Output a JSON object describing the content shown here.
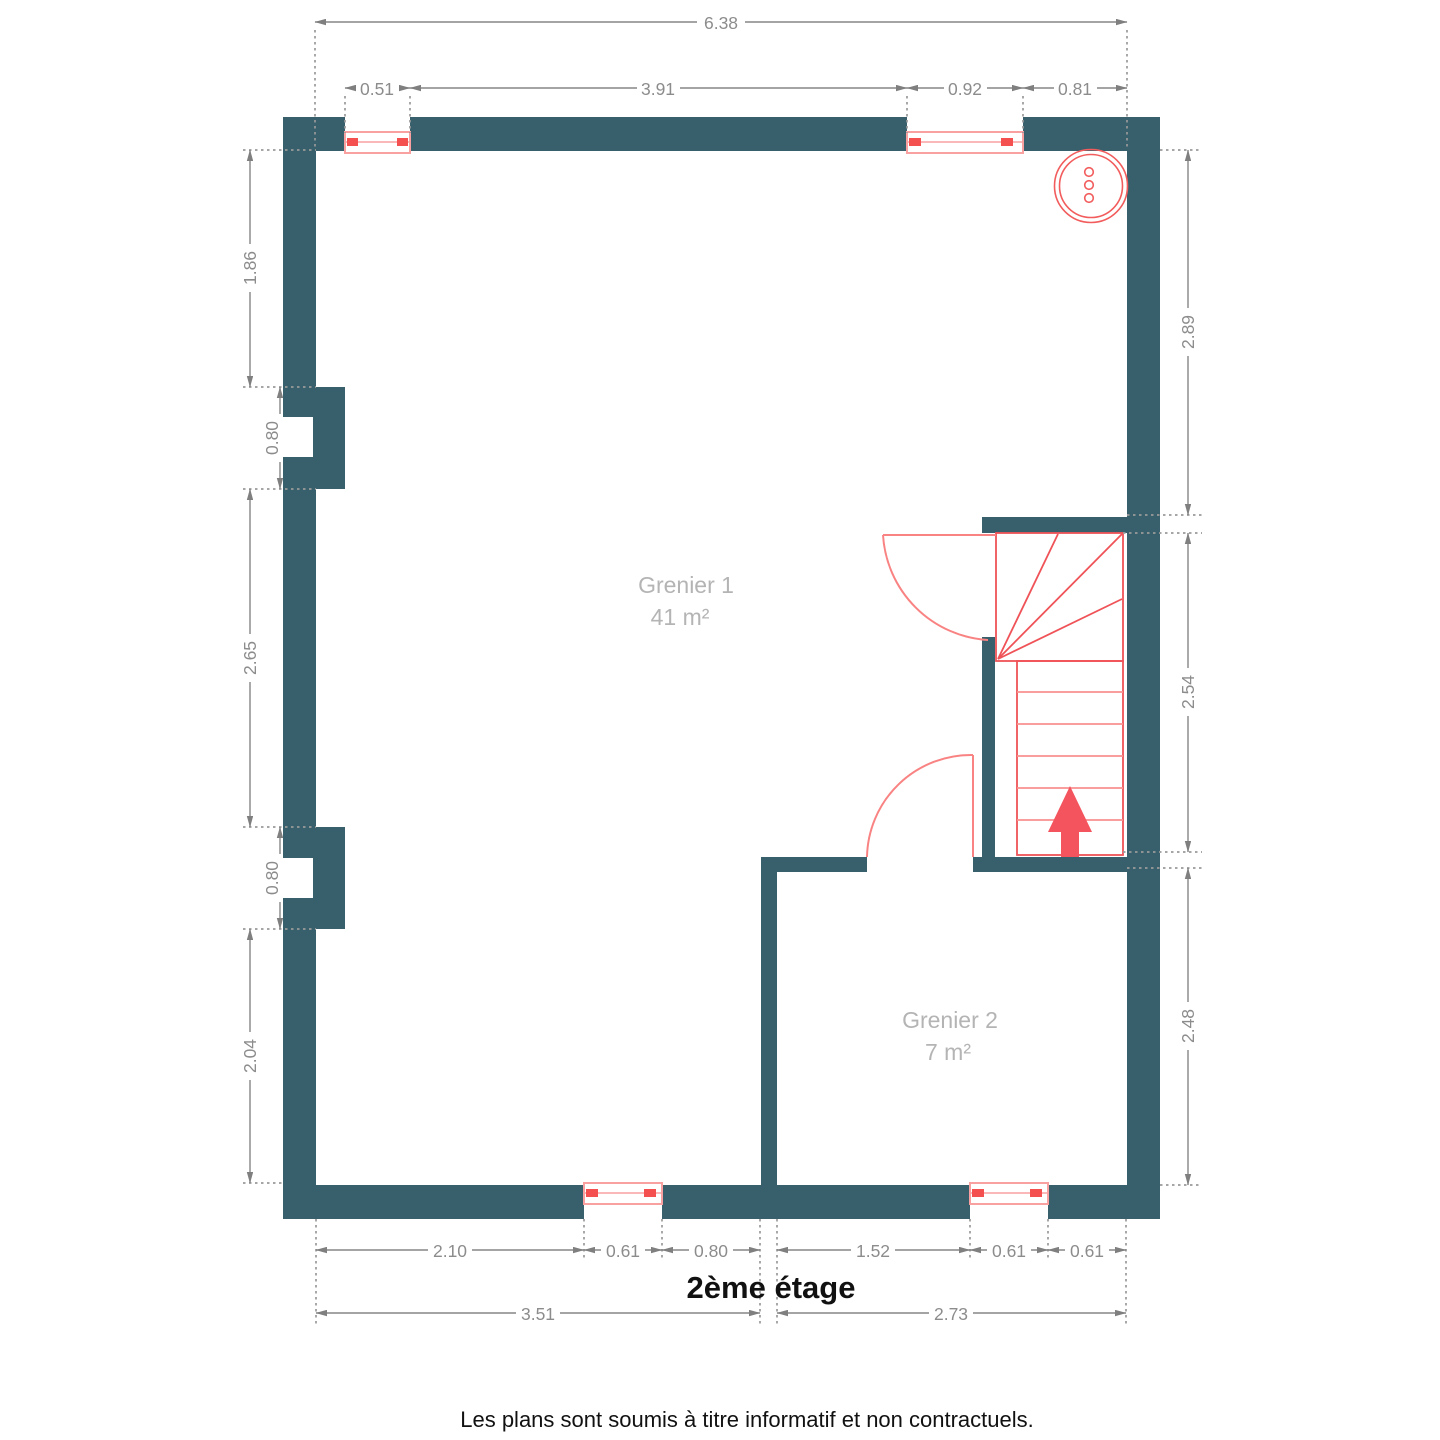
{
  "title": "2ème étage",
  "disclaimer": "Les plans sont soumis à titre informatif et non contractuels.",
  "rooms": [
    {
      "name": "Grenier 1",
      "area": "41 m²"
    },
    {
      "name": "Grenier 2",
      "area": "7 m²"
    }
  ],
  "dims": {
    "top_total": "6.38",
    "top": [
      "0.51",
      "3.91",
      "0.92",
      "0.81"
    ],
    "left": [
      "1.86",
      "0.80",
      "2.65",
      "0.80",
      "2.04"
    ],
    "right": [
      "2.89",
      "2.54",
      "2.48"
    ],
    "bottom": [
      "2.10",
      "0.61",
      "0.80",
      "1.52",
      "0.61",
      "0.61"
    ],
    "bottom_totals": [
      "3.51",
      "2.73"
    ]
  },
  "colors": {
    "wall": "#38606c",
    "stair_red": "#ef5358",
    "window_pink": "#f9a0a0",
    "dimension_gray": "#8c8c8c",
    "room_label_gray": "#b4b4b4",
    "text_black": "#111111"
  }
}
